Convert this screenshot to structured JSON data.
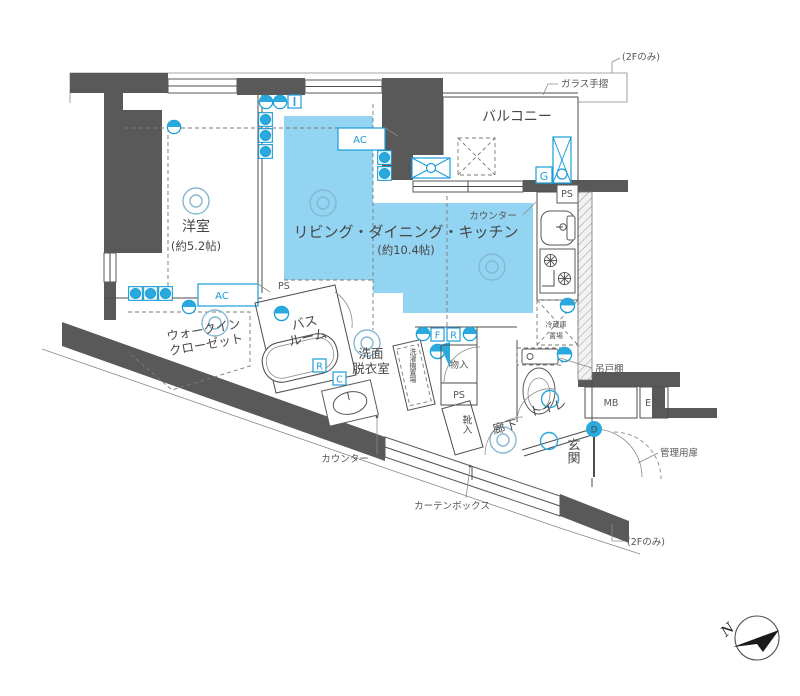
{
  "plan": {
    "rooms": {
      "ldk_name": "リビング・ダイニング・キッチン",
      "ldk_size": "(約10.4帖)",
      "yoshitsu_name": "洋室",
      "yoshitsu_size": "(約5.2帖)",
      "balcony": "バルコニー",
      "wic_line1": "ウォークイン",
      "wic_line2": "クローゼット",
      "bath_line1": "バス",
      "bath_line2": "ルーム",
      "senmen_line1": "洗面",
      "senmen_line2": "脱衣室",
      "toilet": "トイレ",
      "rouka": "廊下",
      "genkan": "玄関"
    },
    "labels": {
      "note_2f": "(2Fのみ)",
      "glass_rail": "ガラス手摺",
      "counter": "カウンター",
      "curtain_box": "カーテンボックス",
      "kanri_door": "管理用扉",
      "tsuridodana": "吊戸棚",
      "reizo_line1": "冷蔵庫",
      "reizo_line2": "置場",
      "mono_ire": "物入",
      "kutsu_ire": "靴入",
      "sentakuki": "洗濯機置場",
      "mb": "MB",
      "eps": "EPS",
      "ps": "PS",
      "ac": "AC",
      "g": "G",
      "r": "R",
      "c": "C",
      "f": "F",
      "d": "D",
      "north": "N"
    },
    "colors": {
      "room_highlight": "#92d4f1",
      "accent_blue": "#1a9cd8",
      "wall_gray": "#595959"
    }
  }
}
